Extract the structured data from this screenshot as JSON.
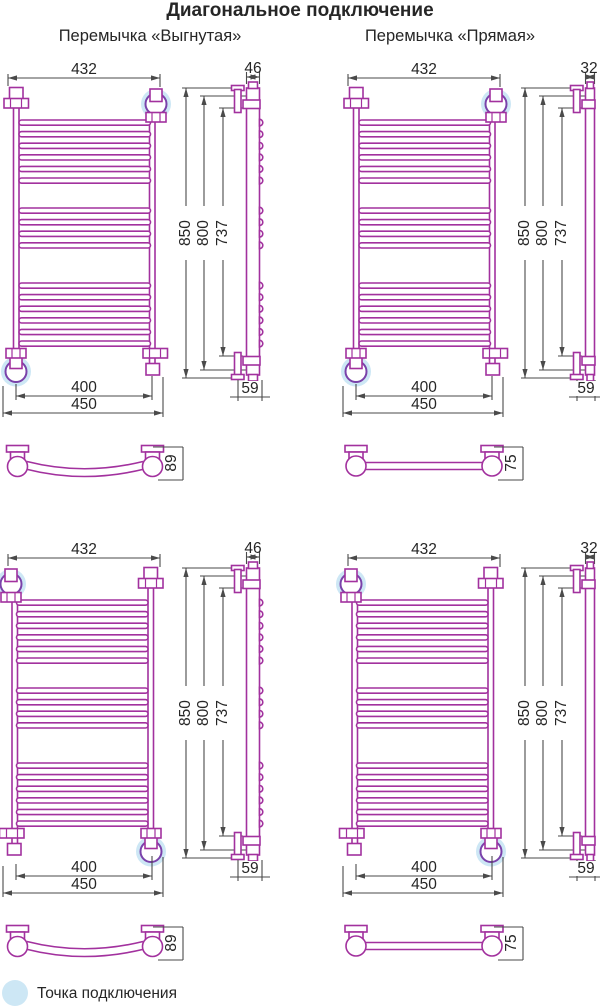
{
  "title": "Диагональное подключение",
  "columns": {
    "left_header": "Перемычка «Выгнутая»",
    "right_header": "Перемычка «Прямая»"
  },
  "dims": {
    "width_top": "432",
    "width_axes": "400",
    "width_overall": "450",
    "height_overall": "850",
    "height_body": "800",
    "height_mounting": "737",
    "depth_top_curved": "46",
    "depth_top_straight": "32",
    "depth_bottom": "59",
    "bar_depth_curved": "89",
    "bar_depth_straight": "75"
  },
  "legend": {
    "label": "Точка подключения"
  },
  "colors": {
    "pipe": "#a2319e",
    "valve": "#7a42aa",
    "dimension": "#4a4a4a",
    "text": "#262626",
    "highlight": "#cde7f5"
  }
}
